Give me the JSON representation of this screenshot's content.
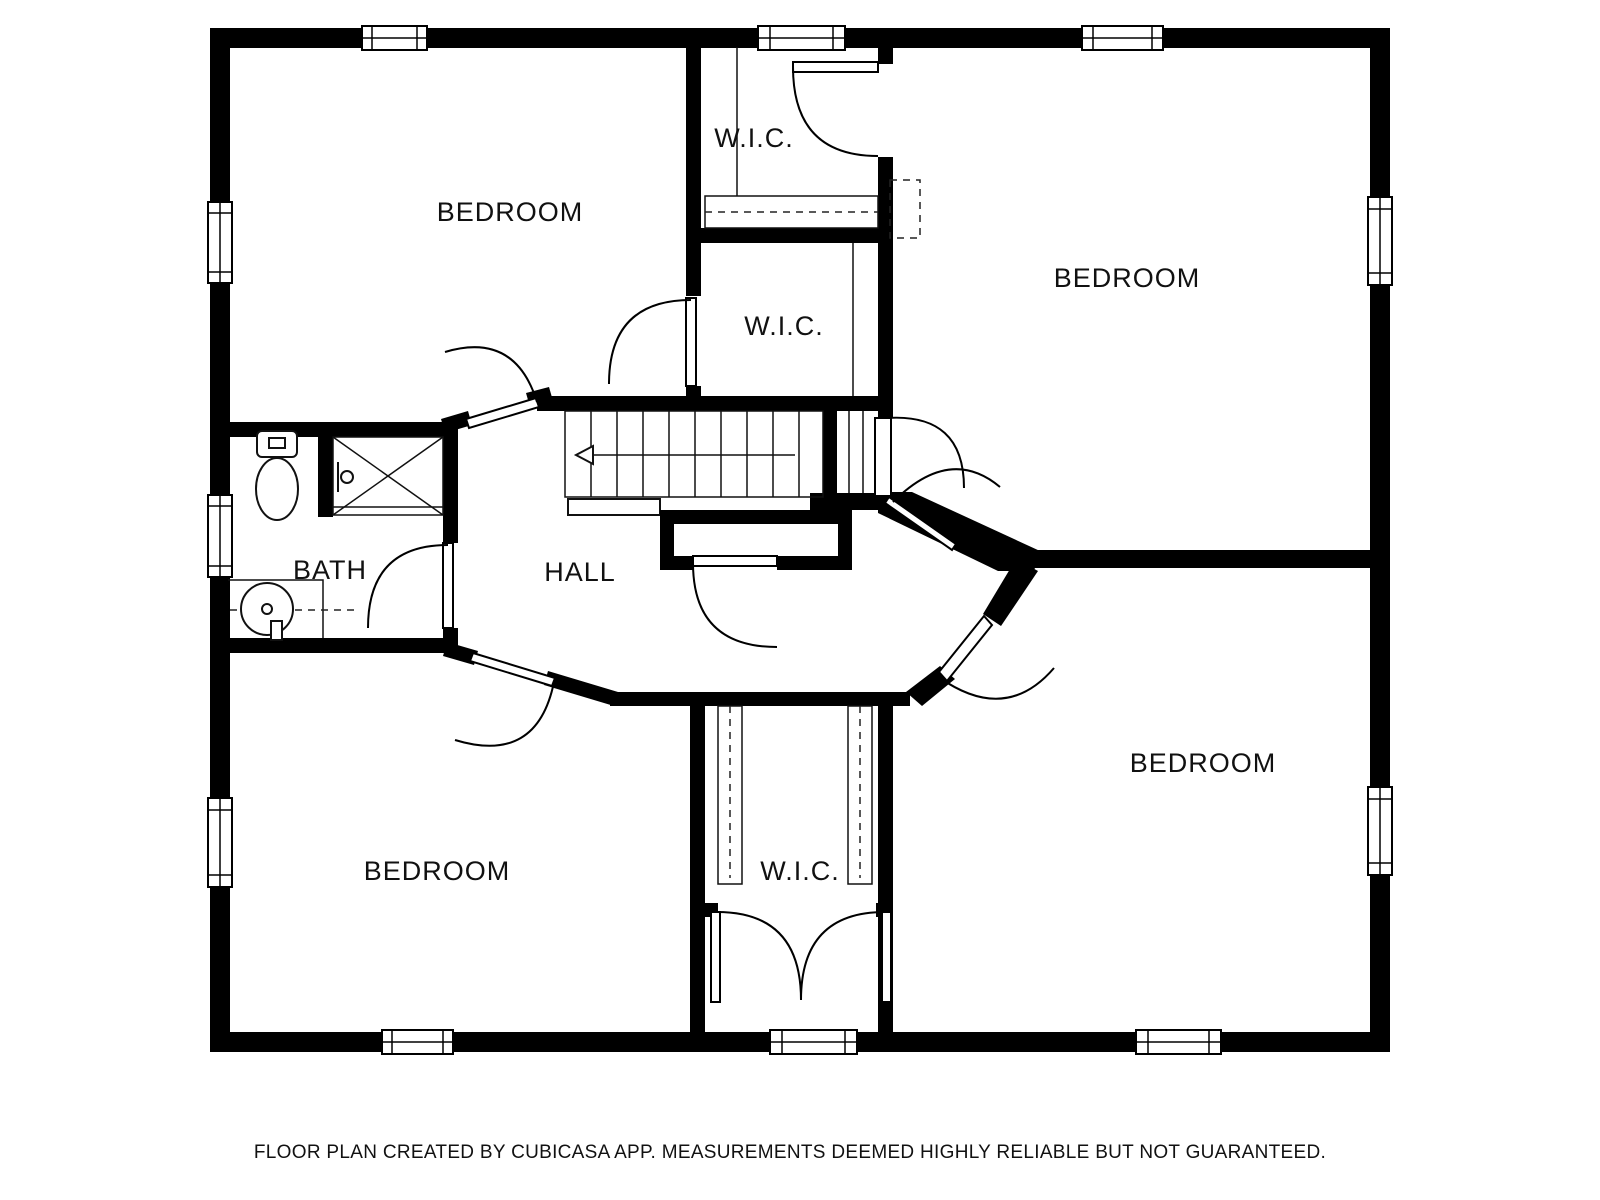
{
  "floor_plan": {
    "rooms": [
      {
        "id": "bedroom-top-left",
        "label": "BEDROOM"
      },
      {
        "id": "wic-top",
        "label": "W.I.C."
      },
      {
        "id": "bedroom-top-right",
        "label": "BEDROOM"
      },
      {
        "id": "wic-middle",
        "label": "W.I.C."
      },
      {
        "id": "bath",
        "label": "BATH"
      },
      {
        "id": "hall",
        "label": "HALL"
      },
      {
        "id": "bedroom-bottom-left",
        "label": "BEDROOM"
      },
      {
        "id": "wic-bottom",
        "label": "W.I.C."
      },
      {
        "id": "bedroom-bottom-right",
        "label": "BEDROOM"
      }
    ],
    "footer": "FLOOR PLAN CREATED BY CUBICASA APP. MEASUREMENTS DEEMED HIGHLY RELIABLE BUT NOT GUARANTEED.",
    "fixtures": [
      "toilet-icon",
      "shower-icon",
      "sink-icon",
      "staircase-icon",
      "stair-direction-arrow-icon",
      "closet-rail",
      "closet-shelf",
      "double-closet-doors",
      "dashed-access-panel"
    ],
    "colors": {
      "wall": "#000000",
      "background": "#ffffff",
      "label": "#111111"
    }
  }
}
